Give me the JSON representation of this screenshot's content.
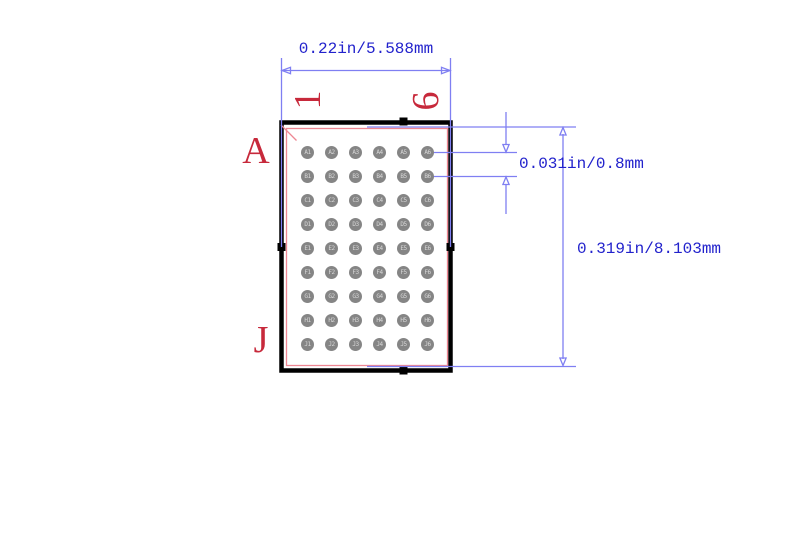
{
  "colors": {
    "background": "#ffffff",
    "outline_black": "#000000",
    "courtyard_pink": "#ee8793",
    "dim_line_blue": "#7f7ff2",
    "dim_text_blue": "#2222cc",
    "label_red": "#c7293b",
    "ball_gray": "#858585",
    "ball_label": "#d8d8d8"
  },
  "dimensions": {
    "width_label": "0.22in/5.588mm",
    "pitch_label": "0.031in/0.8mm",
    "height_label": "0.319in/8.103mm"
  },
  "grid": {
    "first_row_label": "A",
    "last_row_label": "J",
    "first_col_label": "1",
    "last_col_label": "6",
    "row_labels": [
      "A",
      "B",
      "C",
      "D",
      "E",
      "F",
      "G",
      "H",
      "J"
    ],
    "col_labels": [
      "1",
      "2",
      "3",
      "4",
      "5",
      "6"
    ],
    "pins": [
      "A1",
      "A2",
      "A3",
      "A4",
      "A5",
      "A6",
      "B1",
      "B2",
      "B3",
      "B4",
      "B5",
      "B6",
      "C1",
      "C2",
      "C3",
      "C4",
      "C5",
      "C6",
      "D1",
      "D2",
      "D3",
      "D4",
      "D5",
      "D6",
      "E1",
      "E2",
      "E3",
      "E4",
      "E5",
      "E6",
      "F1",
      "F2",
      "F3",
      "F4",
      "F5",
      "F6",
      "G1",
      "G2",
      "G3",
      "G4",
      "G5",
      "G6",
      "H1",
      "H2",
      "H3",
      "H4",
      "H5",
      "H6",
      "J1",
      "J2",
      "J3",
      "J4",
      "J5",
      "J6"
    ]
  }
}
